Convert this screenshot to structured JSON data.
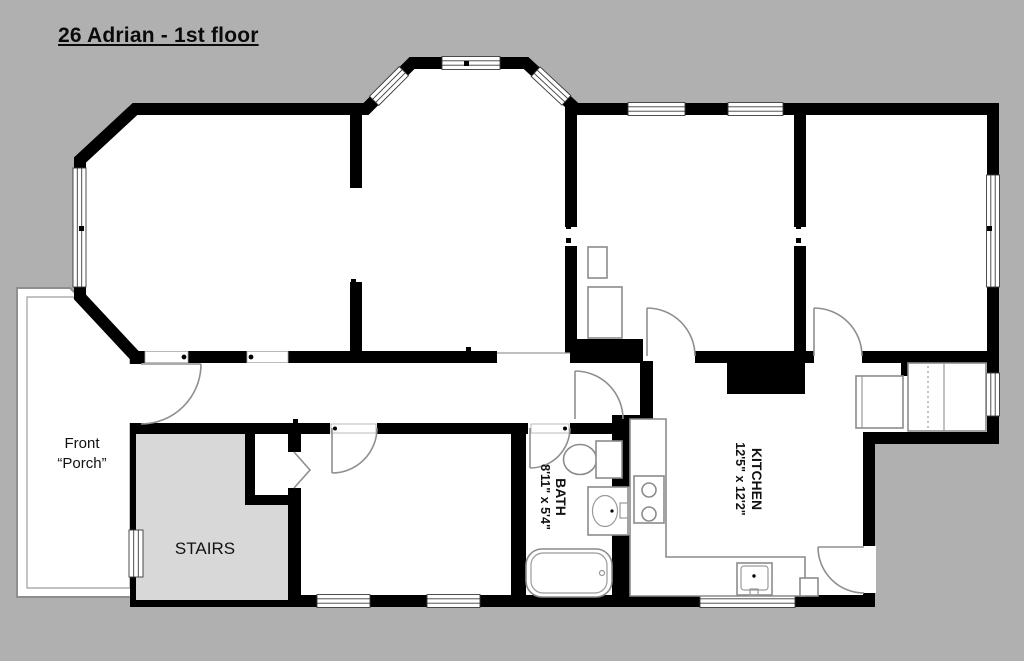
{
  "title": "26 Adrian - 1st floor",
  "rooms": {
    "porch": {
      "label_line1": "Front",
      "label_line2": "“Porch”"
    },
    "stairs": {
      "label": "STAIRS"
    },
    "bath": {
      "label": "BATH",
      "dimensions": "8'11\" x 5'4\""
    },
    "kitchen": {
      "label": "KITCHEN",
      "dimensions": "12'5\" x 12'2\""
    }
  },
  "colors": {
    "background": "#b0b0b0",
    "wall": "#000000",
    "floor": "#ffffff",
    "stairs_fill": "#d8d8d8",
    "fixture_line": "#8c8c8c"
  }
}
